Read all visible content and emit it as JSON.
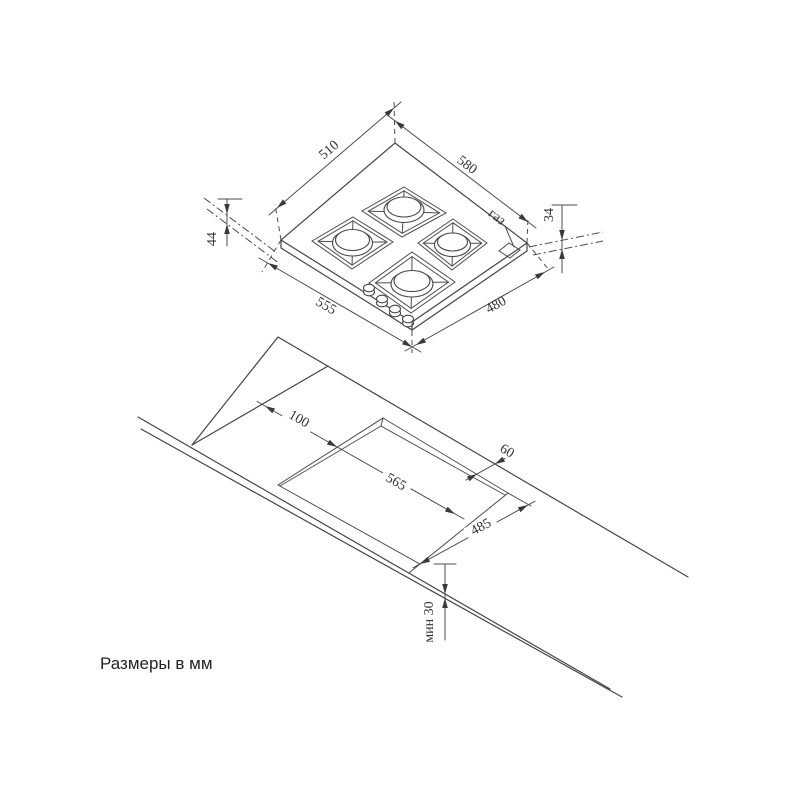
{
  "note": "Размеры в мм",
  "colors": {
    "line": "#454545",
    "background": "#ffffff"
  },
  "hob": {
    "dim_top_left": "510",
    "dim_top_right": "580",
    "dim_bottom_left": "555",
    "dim_bottom_right": "480",
    "dim_height_left": "44",
    "dim_height_right": "34",
    "gas_label": "газ"
  },
  "cutout": {
    "dim_left_offset": "100",
    "dim_length": "565",
    "dim_back_offset": "60",
    "dim_width": "485",
    "dim_front_min": "мин 30"
  }
}
